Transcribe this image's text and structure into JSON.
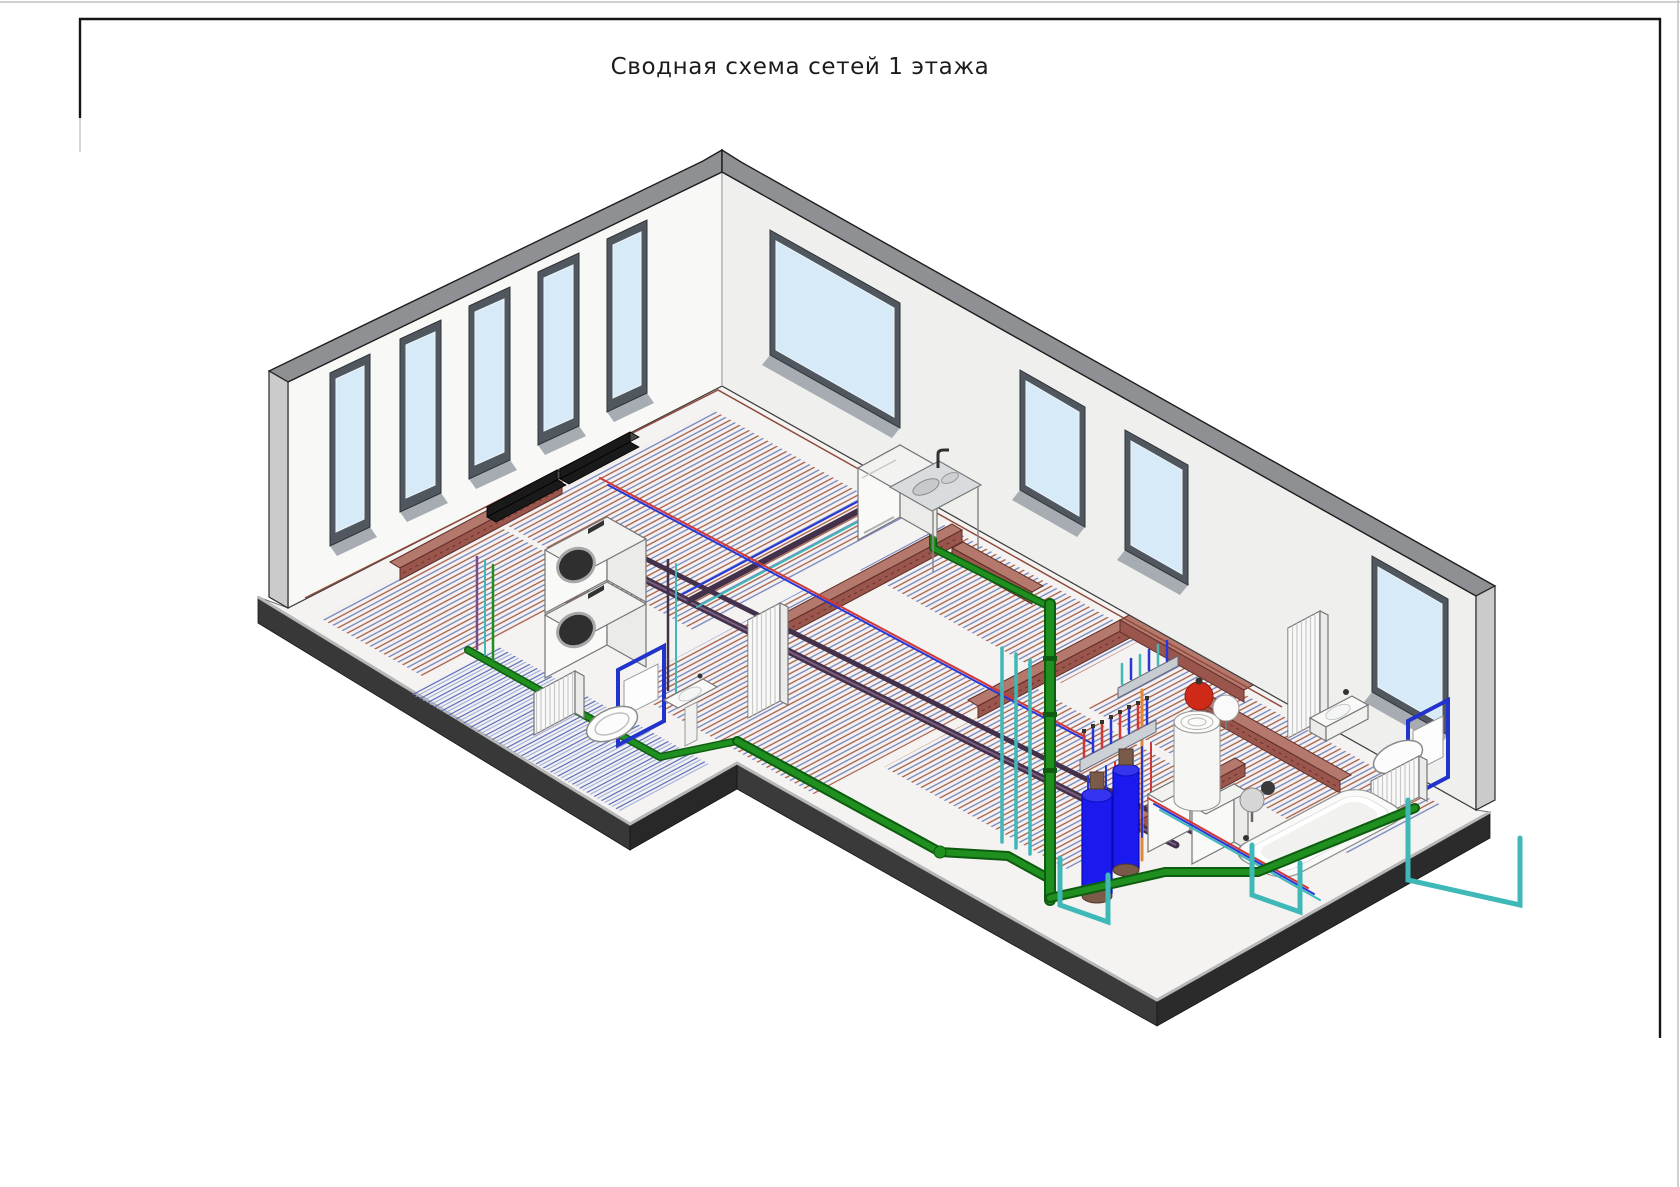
{
  "page": {
    "title": "Сводная схема сетей 1 этажа",
    "background": "#ffffff"
  },
  "sheet": {
    "frame_color": "#151515",
    "page_edge_color": "#c2c2c2"
  },
  "drawing": {
    "type": "isometric-mep-summary-scheme",
    "floor_label_in_title": "1",
    "windows": {
      "left_wall_count": 5,
      "right_wall_count": 4
    },
    "components": [
      "trench-convector",
      "trench-convector",
      "stacked-washer-dryer",
      "panel-radiator",
      "wall-hung-toilet-with-install-frame",
      "pedestal-washbasin",
      "column-radiator",
      "kitchen-sink-cabinet",
      "sewage-riser",
      "water-filter-tank",
      "water-filter-tank",
      "heating-manifold",
      "heating-manifold",
      "water-heater-cylinder",
      "red-expansion-tank",
      "white-expansion-tank",
      "wall-boiler",
      "wall-boiler",
      "gray-membrane-tank",
      "circulation-pump",
      "bathtub",
      "wall-hung-washbasin",
      "wall-hung-toilet-with-install-frame",
      "panel-radiator",
      "column-radiator",
      "underfloor-heating-zones",
      "brick-plinths",
      "cold-water-loops"
    ]
  },
  "colors": {
    "wall_face_left": "#f8f8f6",
    "wall_face_right": "#efefee",
    "wall_top_band": "#8f9093",
    "wall_end_cap": "#cbcbcb",
    "glass": "#d7eaf8",
    "window_frame": "#51575e",
    "window_reveal": "#a6acb1",
    "floor": "#f4f3f1",
    "slab_side": "#333333",
    "slab_bevel": "#b8b8b8",
    "heating_supply": "#a85843",
    "heating_return": "#7381bd",
    "sewage": "#1f8f1f",
    "sewage_dark": "#0e5c10",
    "cold_water": "#3fb8b8",
    "hot_water": "#d03838",
    "blue_pipe": "#2838d8",
    "orange_pipe": "#e08838",
    "purple_bundle": "#43304a",
    "brick": "#9a564c",
    "brick_top": "#b5786c",
    "tank_blue": "#1a1aee",
    "tank_cap": "#7a5a48",
    "expansion_red": "#cf2a18",
    "frame_blue": "#2233cc",
    "convector_black": "#1a1a1a"
  }
}
